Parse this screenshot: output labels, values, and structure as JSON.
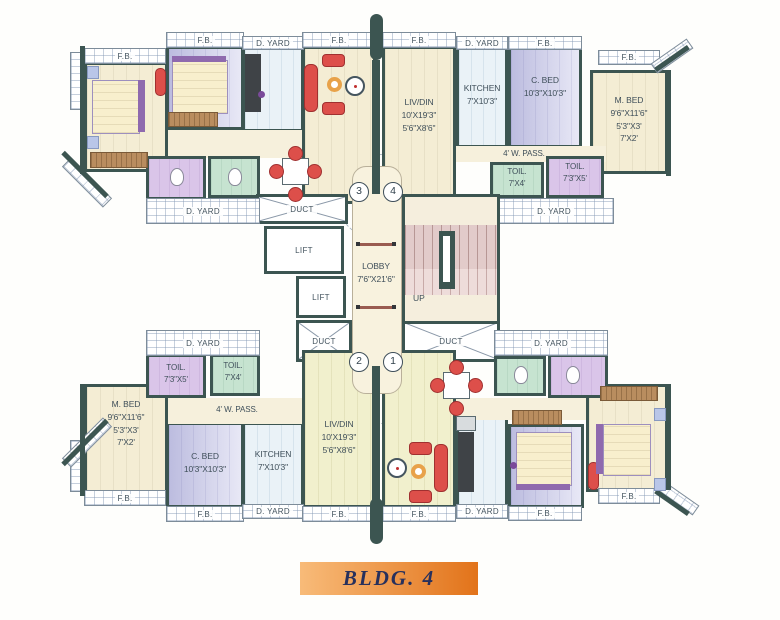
{
  "banner": {
    "text": "BLDG. 4",
    "bg_from": "#f8bb79",
    "bg_to": "#e2731a",
    "text_color": "#27305c"
  },
  "labels": {
    "fb": "F.B.",
    "dyard": "D. YARD",
    "pass": "4' W. PASS."
  },
  "core": {
    "duct": "DUCT",
    "lift": "LIFT",
    "up": "UP",
    "lobby": {
      "name": "LOBBY",
      "dim": "7'6\"X21'6\""
    },
    "units": {
      "u1": "1",
      "u2": "2",
      "u3": "3",
      "u4": "4"
    }
  },
  "rooms": {
    "livdin": {
      "name": "LIV/DIN",
      "dim1": "10'X19'3\"",
      "dim2": "5'6\"X8'6\""
    },
    "kitchen": {
      "name": "KITCHEN",
      "dim": "7'X10'3\""
    },
    "cbed": {
      "name": "C. BED",
      "dim": "10'3\"X10'3\""
    },
    "mbed": {
      "name": "M. BED",
      "dim1": "9'6\"X11'6\"",
      "dim2": "5'3\"X3'",
      "dim3": "7'X2'"
    },
    "toil_small": {
      "name": "TOIL.",
      "dim": "7'X4'"
    },
    "toil_big": {
      "name": "TOIL.",
      "dim": "7'3\"X5'"
    }
  },
  "colors": {
    "wall": "#3c5551",
    "cream": "#f4edd4",
    "cream_yellow": "#f1f0cd",
    "lavender": "#c3c3e2",
    "pale_blue": "#eaf2f7",
    "toilet_green": "#c6e3d0",
    "toilet_purple": "#dac5e9",
    "stair_pink": "#e3cccb",
    "furniture_red": "#dd4f4a",
    "banner_orange": "#e2731a"
  }
}
